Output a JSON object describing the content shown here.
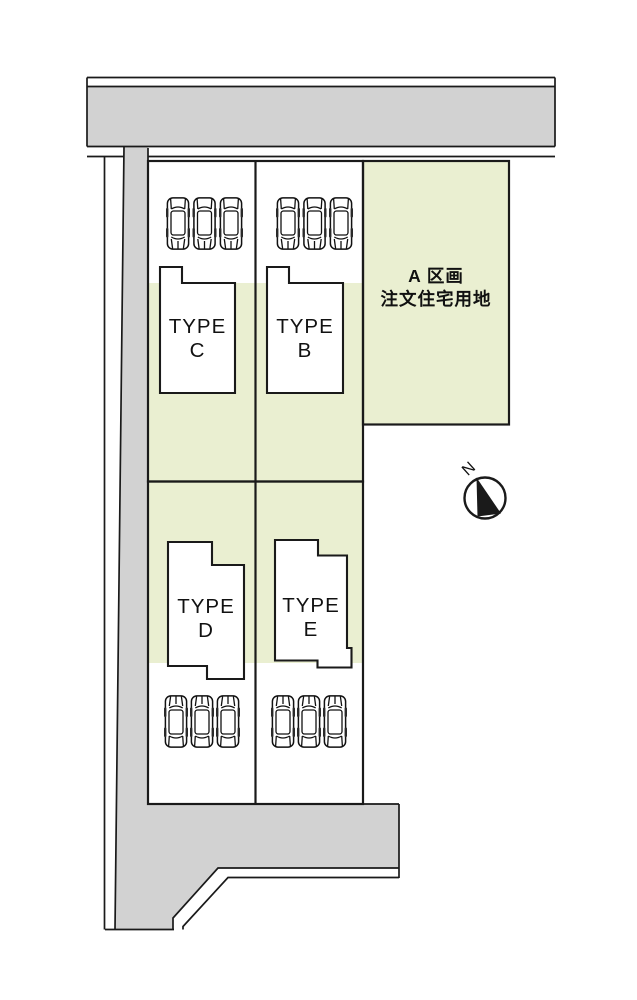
{
  "colors": {
    "road": "#d2d2d2",
    "green": "#eaefd1",
    "line": "#1a1a1a",
    "background": "#ffffff"
  },
  "plots": {
    "a": {
      "line1": "A 区画",
      "line2": "注文住宅用地"
    },
    "b": {
      "line1": "TYPE",
      "line2": "B"
    },
    "c": {
      "line1": "TYPE",
      "line2": "C"
    },
    "d": {
      "line1": "TYPE",
      "line2": "D"
    },
    "e": {
      "line1": "TYPE",
      "line2": "E"
    },
    "parking_spaces_per_plot": 3
  },
  "compass": {
    "north": "N"
  },
  "icons": {
    "car": "car-icon",
    "compass": "north-arrow-icon"
  }
}
